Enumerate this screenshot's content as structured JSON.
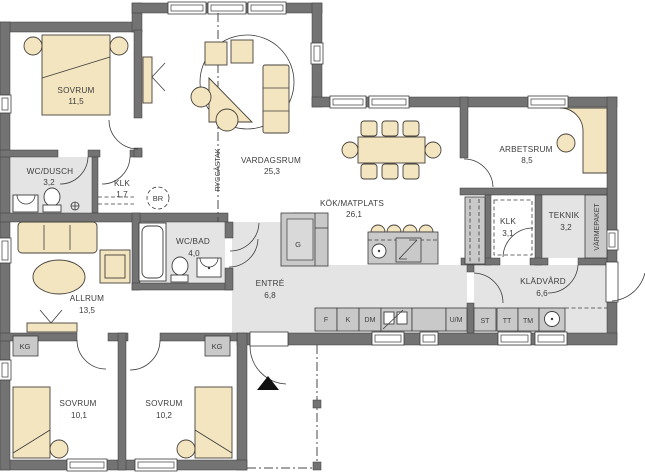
{
  "plan": {
    "rooms": {
      "sovrum1": {
        "name": "SOVRUM",
        "area": "11,5"
      },
      "wc_dusch": {
        "name": "WC/DUSCH",
        "area": "3,2"
      },
      "klk1": {
        "name": "KLK",
        "area": "1,7"
      },
      "vardagsrum": {
        "name": "VARDAGSRUM",
        "area": "25,3"
      },
      "kok": {
        "name": "KÖK/MATPLATS",
        "area": "26,1"
      },
      "arbetsrum": {
        "name": "ARBETSRUM",
        "area": "8,5"
      },
      "klk2": {
        "name": "KLK",
        "area": "3,1"
      },
      "teknik": {
        "name": "TEKNIK",
        "area": "3,2"
      },
      "kladvard": {
        "name": "KLÄDVÅRD",
        "area": "6,6"
      },
      "entre": {
        "name": "ENTRÉ",
        "area": "6,8"
      },
      "wc_bad": {
        "name": "WC/BAD",
        "area": "4,0"
      },
      "allrum": {
        "name": "ALLRUM",
        "area": "13,5"
      },
      "sovrum2": {
        "name": "SOVRUM",
        "area": "10,1"
      },
      "sovrum3": {
        "name": "SOVRUM",
        "area": "10,2"
      }
    },
    "annotations": {
      "ridge": "RYGGÅSTAK",
      "varmepaket": "VÄRMEPAKET",
      "smoke_detector": "BR",
      "wardrobe": "G",
      "kg": "KG"
    },
    "appliances": {
      "f": "F",
      "k": "K",
      "dm": "DM",
      "um": "U/M",
      "st": "ST",
      "tt": "TT",
      "tm": "TM"
    },
    "colors": {
      "wall": "#737373",
      "floor_gray": "#e4e4e4",
      "furniture": "#f3e5c0",
      "appliance": "#c9c9c9"
    }
  }
}
